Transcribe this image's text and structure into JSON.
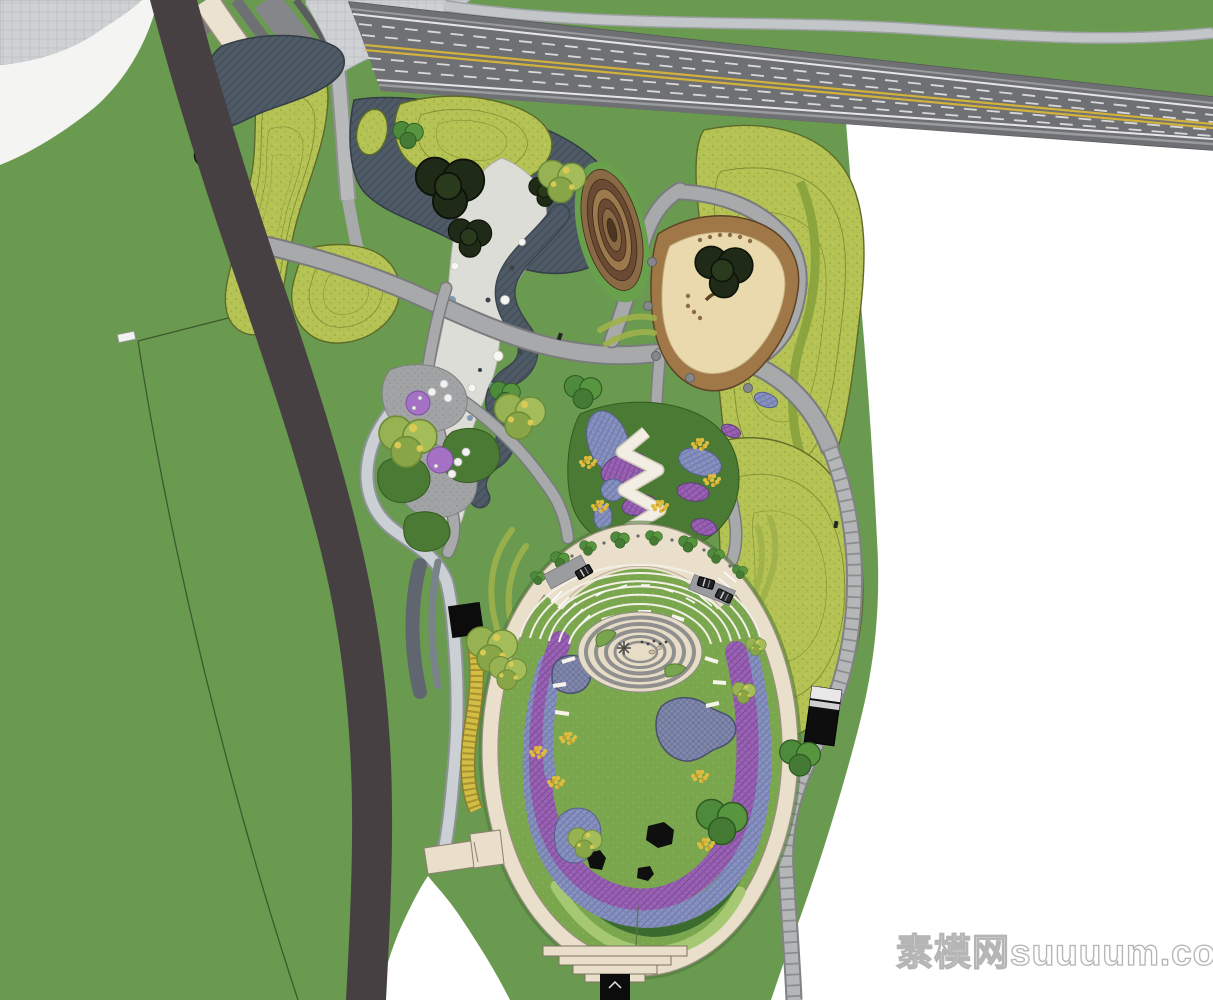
{
  "watermark": {
    "text": "素模网suuuum.com"
  },
  "palette": {
    "site-green": "#6a9a50",
    "lawn": "#7aa74e",
    "meadow": "#b5c355",
    "meadow-line": "#5d6a28",
    "water": "#4e5a66",
    "gravel": "#ddddd7",
    "road": "#474043",
    "highway": "#6f7073",
    "lane-yellow": "#d2b23a",
    "lane-white": "#e6e6e6",
    "path": "#a8a9ab",
    "walkway": "#cbd0d5",
    "stone": "#b4b6b8",
    "plaza": "#cfd2d4",
    "cream": "#ece2d0",
    "beige": "#e9dfca",
    "plaza-center": "#e7dcc6",
    "sand": "#ead9ad",
    "sand-edge": "#a07848",
    "spiral": "#8a6a45",
    "purple": "#9a62b4",
    "blue-bed": "#8892c0",
    "pond": "#8089ad",
    "hedge": "#3b6c2d",
    "dark-planting": "#4a7a33",
    "flower-yellow": "#e0bc3e",
    "flower-purple": "#a571c4",
    "tree-dark": "#1f2b17",
    "tree-green": "#4e8a3c",
    "tree-light": "#97b252",
    "rock": "#0f0f0f",
    "white": "#ffffff",
    "watermark-gray": "#b0b0b0"
  }
}
